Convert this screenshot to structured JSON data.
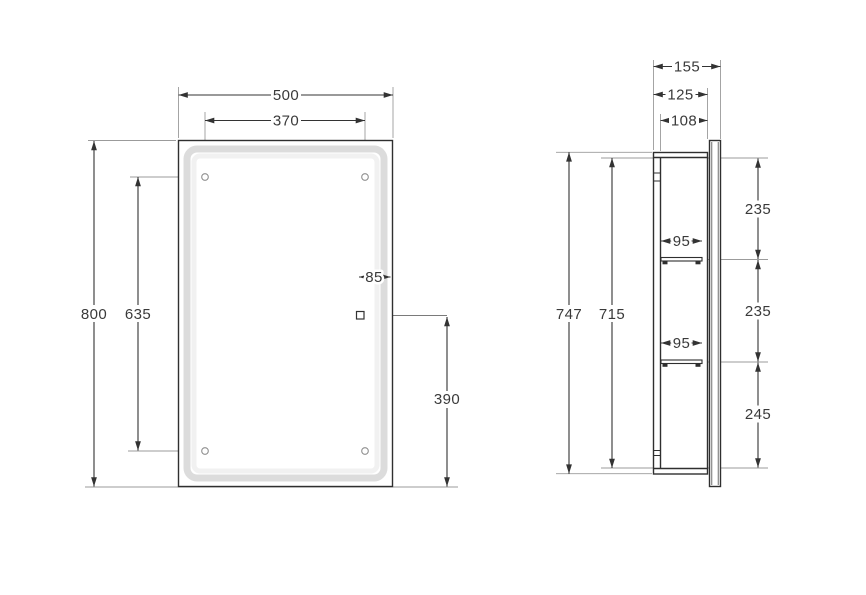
{
  "drawing": {
    "colors": {
      "line": "#2f2f2f",
      "dimension_text": "#3a3a3a",
      "extension_line": "#9b9b9b",
      "led_band": "#dcdcdc"
    },
    "front_view": {
      "width_mm": "500",
      "hole_spacing_horizontal_mm": "370",
      "height_mm": "800",
      "hole_spacing_vertical_mm": "635",
      "power_point_offset_mm": "85",
      "power_point_height_mm": "390"
    },
    "side_view": {
      "depth_overall_mm": "155",
      "depth_body_mm": "125",
      "depth_interior_mm": "108",
      "height_body_mm": "747",
      "height_interior_mm": "715",
      "upper_shelf_depth_mm": "95",
      "lower_shelf_depth_mm": "95",
      "top_section_mm": "235",
      "middle_section_mm": "235",
      "bottom_section_mm": "245"
    }
  }
}
